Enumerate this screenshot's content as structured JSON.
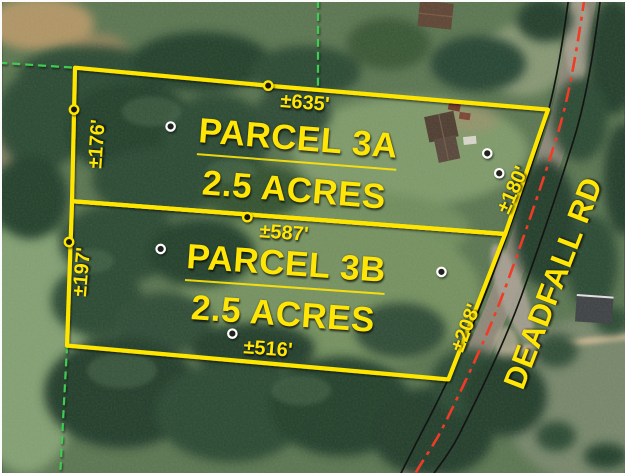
{
  "listing_map": {
    "road": {
      "name": "DEADFALL RD"
    },
    "parcels": [
      {
        "id": "3A",
        "name": "PARCEL 3A",
        "acreage": "2.5 ACRES"
      },
      {
        "id": "3B",
        "name": "PARCEL 3B",
        "acreage": "2.5 ACRES"
      }
    ],
    "dimensions": {
      "parcel_3a_top": "±635'",
      "parcel_3a_left": "±176'",
      "parcel_3a_right": "±180'",
      "middle_shared": "±587'",
      "parcel_3b_left": "±197'",
      "parcel_3b_right": "±208'",
      "parcel_3b_bottom": "±516'"
    },
    "markers": {
      "boundary_vertex_markers": 4,
      "interior_point_markers": 6
    },
    "colors": {
      "parcel_boundary": "#FFE606",
      "label_text": "#FFE606",
      "road_centerline": "#F03B26",
      "road_casing": "#141414",
      "adjoining_dashed": "#3FCB52",
      "interior_marker_ring": "#FFFFFF"
    }
  }
}
